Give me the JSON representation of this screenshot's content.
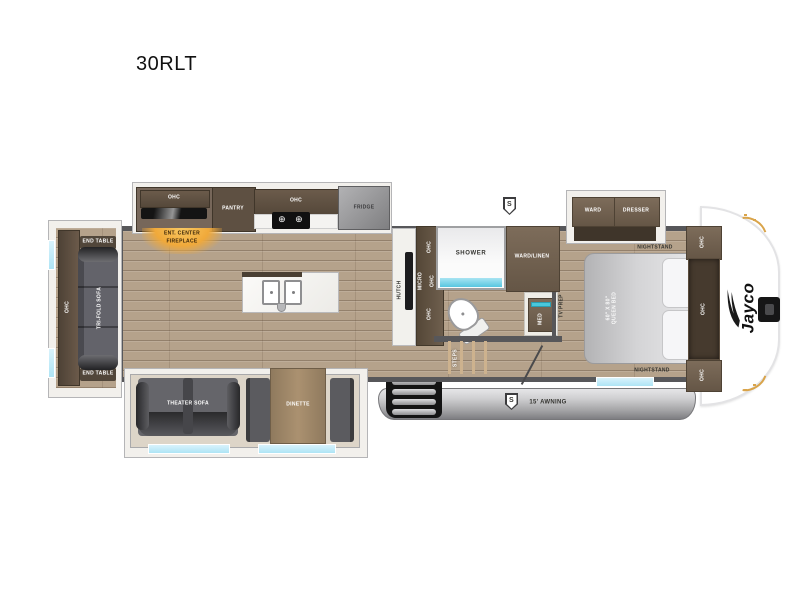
{
  "title": "30RLT",
  "brand": {
    "logo_text": "Jayco"
  },
  "icons": {
    "burner": "⊕"
  },
  "exterior": {
    "awning_label": "15' AWNING",
    "speaker_top": "S",
    "speaker_awning": "S"
  },
  "rear_slide": {
    "ohc": "OHC",
    "end_table_top": "END TABLE",
    "sofa": "TRI-FOLD SOFA",
    "end_table_bottom": "END TABLE"
  },
  "kitchen": {
    "ohc_left": "OHC",
    "pantry": "PANTRY",
    "ohc_range": "OHC",
    "fridge": "FRIDGE",
    "ent_center_line1": "ENT. CENTER",
    "ent_center_line2": "FIREPLACE"
  },
  "galley": {
    "hutch": "HUTCH",
    "ohc_top": "OHC",
    "micro": "MICRO",
    "ohc_mid": "OHC",
    "ohc_bottom": "OHC"
  },
  "bath": {
    "shower": "SHOWER",
    "ward_linen": "WARD/LINEN",
    "med": "MED",
    "tv_prep": "TV PREP",
    "steps": "STEPS"
  },
  "bottom_slide": {
    "theater_sofa": "THEATER SOFA",
    "dinette": "DINETTE"
  },
  "bedroom": {
    "ward": "WARD",
    "dresser": "DRESSER",
    "nightstand_top": "NIGHTSTAND",
    "nightstand_bottom": "NIGHTSTAND",
    "bed_size": "60\" X 80\"",
    "bed_type": "QUEEN BED",
    "ohc_top": "OHC",
    "ohc_mid": "OHC",
    "ohc_bottom": "OHC"
  },
  "colors": {
    "wood": "#b5a28b",
    "wall": "#57575a",
    "cabinet_dark": "#5a4d3f",
    "cabinet_mid": "#6e5e4e",
    "window": "#c6ecf8",
    "glow": "#f0a93a",
    "awning": "#a7a7a9",
    "gold": "#d9a44a"
  }
}
